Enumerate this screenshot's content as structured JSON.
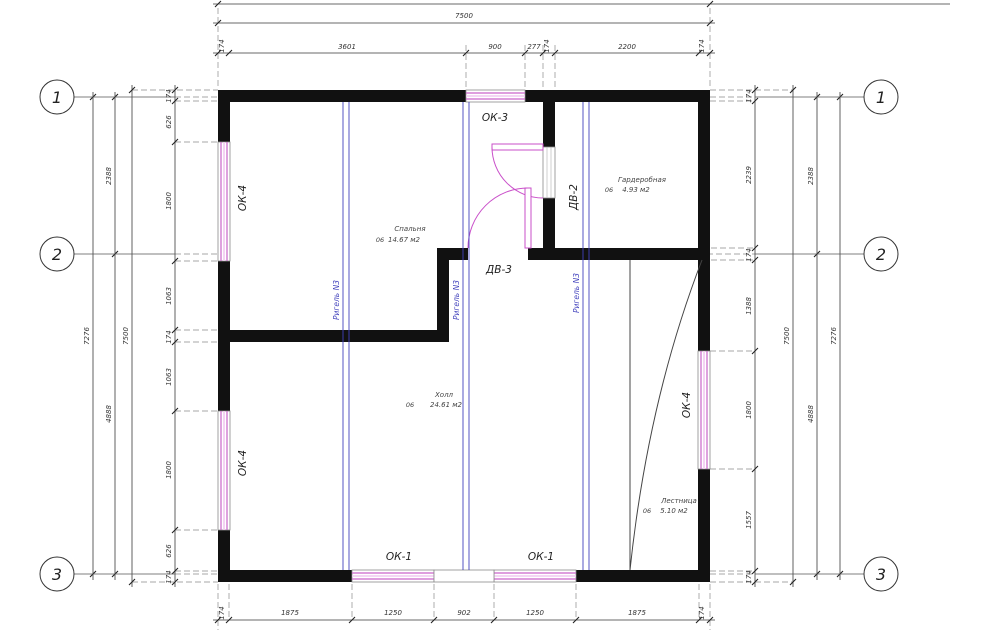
{
  "title": "Floor plan working drawing",
  "axes": {
    "left": [
      "1",
      "2",
      "3"
    ],
    "right": [
      "1",
      "2",
      "3"
    ]
  },
  "dims": {
    "top": {
      "overall": "7500",
      "d": [
        "174",
        "3601",
        "900",
        "277",
        "174",
        "2200",
        "174"
      ]
    },
    "bottom": {
      "d": [
        "174",
        "1875",
        "1250",
        "902",
        "1250",
        "1875",
        "174"
      ]
    },
    "left": {
      "total_axes": "7276",
      "segments": [
        "2388",
        "4888"
      ],
      "overall": "7500",
      "d": [
        "174",
        "626",
        "1800",
        "1063",
        "174",
        "1063",
        "1800",
        "626",
        "174"
      ]
    },
    "right": {
      "total_axes": "7276",
      "segments": [
        "2388",
        "4888"
      ],
      "overall": "7500",
      "d": [
        "174",
        "2239",
        "174",
        "1388",
        "1800",
        "1557",
        "174"
      ]
    }
  },
  "rooms": {
    "bedroom": {
      "num": "06",
      "name": "Спальня",
      "area": "14.67 м2"
    },
    "wardrobe": {
      "num": "06",
      "name": "Гардеробная",
      "area": "4.93 м2"
    },
    "hall": {
      "num": "06",
      "name": "Холл",
      "area": "24.61 м2"
    },
    "stairs": {
      "num": "06",
      "name": "Лестница",
      "area": "5.10 м2"
    }
  },
  "openings": {
    "window_top": "ОК-3",
    "window_left_top": "ОК-4",
    "window_left_bottom": "ОК-4",
    "window_right": "ОК-4",
    "window_bottom_left": "ОК-1",
    "window_bottom_right": "ОК-1",
    "door_wardrobe": "ДВ-2",
    "door_hall": "ДВ-3"
  },
  "beams": {
    "label": "Ригель N3"
  },
  "colors": {
    "wall": "#111111",
    "window": "#c965c9",
    "window_light": "#f0c8f0",
    "door": "#c94fc9",
    "beam": "#4242bd",
    "dimension": "#3a3a3a",
    "extension": "#8a8a8a",
    "background": "#ffffff"
  }
}
